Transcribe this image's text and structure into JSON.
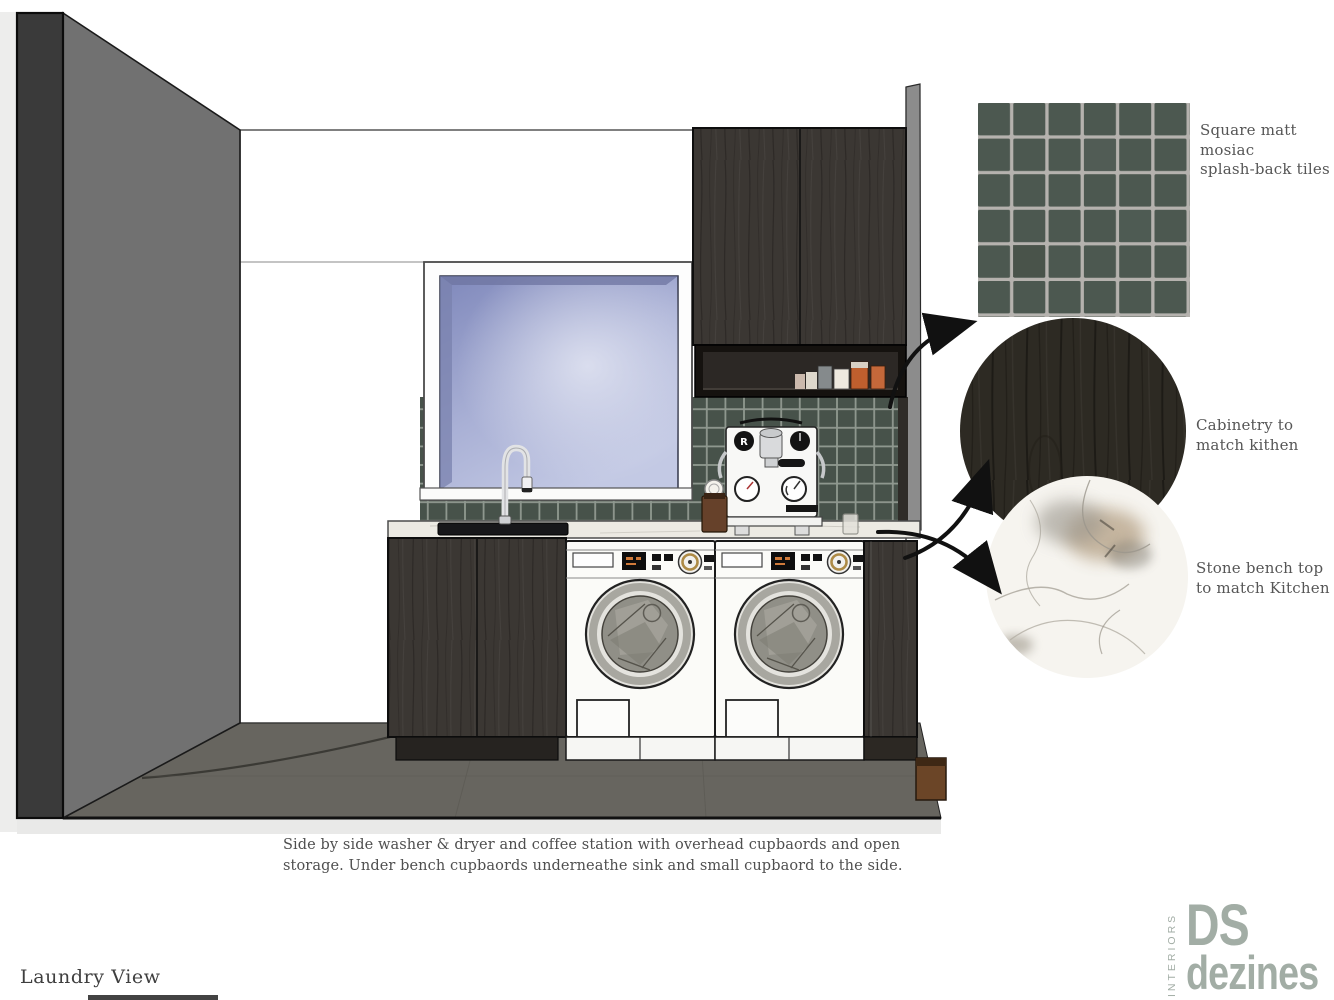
{
  "board": {
    "view_label": "Laundry View",
    "caption": "Side by side washer & dryer and coffee station with overhead cupbaords and open storage. Under bench cupbaords underneathe sink and small cupbaord to the side."
  },
  "annotations": [
    {
      "id": "tiles",
      "text": "Square matt\nmosiac\nsplash-back tiles"
    },
    {
      "id": "cabinetry",
      "text": "Cabinetry to\nmatch kithen"
    },
    {
      "id": "stone",
      "text": "Stone bench top\nto match Kitchen"
    }
  ],
  "logo": {
    "interiors": "INTERIORS",
    "ds": "DS",
    "dezines": "dezines"
  },
  "colors": {
    "tile_green": "#4c5850",
    "tile_green_dark": "#47524a",
    "grout": "#b5b2ae",
    "grout_render": "#8f988f",
    "cabinet_wood": "#3b3733",
    "cabinet_wood_dark": "#29251f",
    "bench_stone": "#eceae3",
    "wall_gray": "#717171",
    "wall_gray_light": "#8c8c8c",
    "wall_edge_dark": "#3a3a3a",
    "floor": "#67655f",
    "sky_blue": "#98a2cf",
    "arrow_black": "#111111",
    "gold": "#ad8a45",
    "text_gray": "#565656",
    "logo_green_gray": "#a2ada5",
    "accent_orange": "#bf5f2e"
  }
}
